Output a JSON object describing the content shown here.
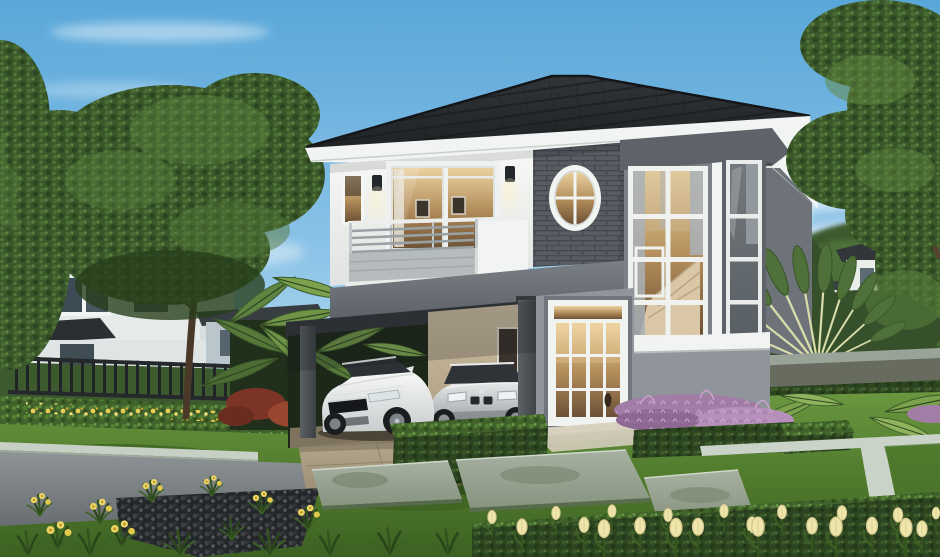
{
  "scene": {
    "type": "architectural-3d-rendering",
    "description": "Photorealistic rendering of a modern two-storey detached house with a dark tiled hip roof, white and grey walls, a charcoal brick accent wall with an oval window, a balcony with metal railing, a two-storey bay window tower with a staircase inside, and a carport sheltering a white sports coupe and a silver sedan. Manicured lawn, trimmed box hedges, stone slab path, purple fountain grass, yellow flowers and tulips in the foreground; neighbouring houses, garden fence, large trees and a travellers palm under a clear blue sky.",
    "setting": "residential estate, daytime, clear sky",
    "main_house": {
      "storeys": 2,
      "roof": "dark charcoal tile hip roof with white fascia",
      "features": [
        "balcony with steel railing",
        "sliding glass door",
        "oval window",
        "brick accent wall",
        "two-storey bay window tower",
        "interior staircase visible",
        "wall lamps",
        "white french entrance door",
        "carport"
      ]
    },
    "vehicles": [
      "white sports coupe",
      "silver sedan"
    ],
    "vegetation": [
      "large broadleaf tree",
      "travellers palm fan",
      "banana palms",
      "trimmed box hedges",
      "purple fountain grass",
      "yellow flower border",
      "cream tulips",
      "lawn"
    ],
    "background": [
      "neighbour house left",
      "neighbour annex",
      "distant house right",
      "garden fence",
      "boundary wall"
    ],
    "palette": {
      "sky_top": "#59a7d9",
      "sky_mid": "#8cc3e7",
      "sky_horizon": "#d9ecf7",
      "cloud": "#ffffff",
      "roof_dark": "#26282c",
      "roof_shadow": "#17191c",
      "white_trim": "#f1f4f2",
      "wall_white": "#eef0ee",
      "brick_gray": "#575d62",
      "gray_dark": "#5d6369",
      "gray_mid": "#7b8187",
      "gray_band": "#6a7076",
      "gray_wall_light": "#8f959a",
      "window_frame": "#ffffff",
      "glass_warm": "#c9a368",
      "glass_cool": "#9fb2bd",
      "curtain": "#a7afb5",
      "carport_ceiling": "#34383b",
      "column": "#4a4f54",
      "carport_wall_tan": "#c3b499",
      "car_white": "#f0f2f1",
      "car_silver": "#c9cdce",
      "car_glass": "#2e3338",
      "tire": "#1b1d1f",
      "lawn_light": "#6b9840",
      "lawn_dark": "#3c6122",
      "hedge_dark": "#2c4420",
      "hedge_light": "#4a6e2e",
      "tree_green": "#3f5d2b",
      "tree_highlight": "#628740",
      "trunk": "#4c3a2a",
      "palm_stem": "#d8dcab",
      "street_gray": "#7c8184",
      "curb": "#c6d0c4",
      "stone_border": "#c9d3c7",
      "paver_tan": "#b3a489",
      "pebble_dark": "#26292c",
      "stone_slab": "#99a496",
      "purple_light": "#c39fc6",
      "purple_dark": "#8a6590",
      "flower_yellow": "#e7cd55",
      "tulip_cream": "#efe6ad",
      "fence_dark": "#212427",
      "distant_roof": "#32363a",
      "distant_wall": "#e8edea",
      "annex_wall": "#b9c6cc",
      "awning_roof": "#6b4a33"
    }
  }
}
